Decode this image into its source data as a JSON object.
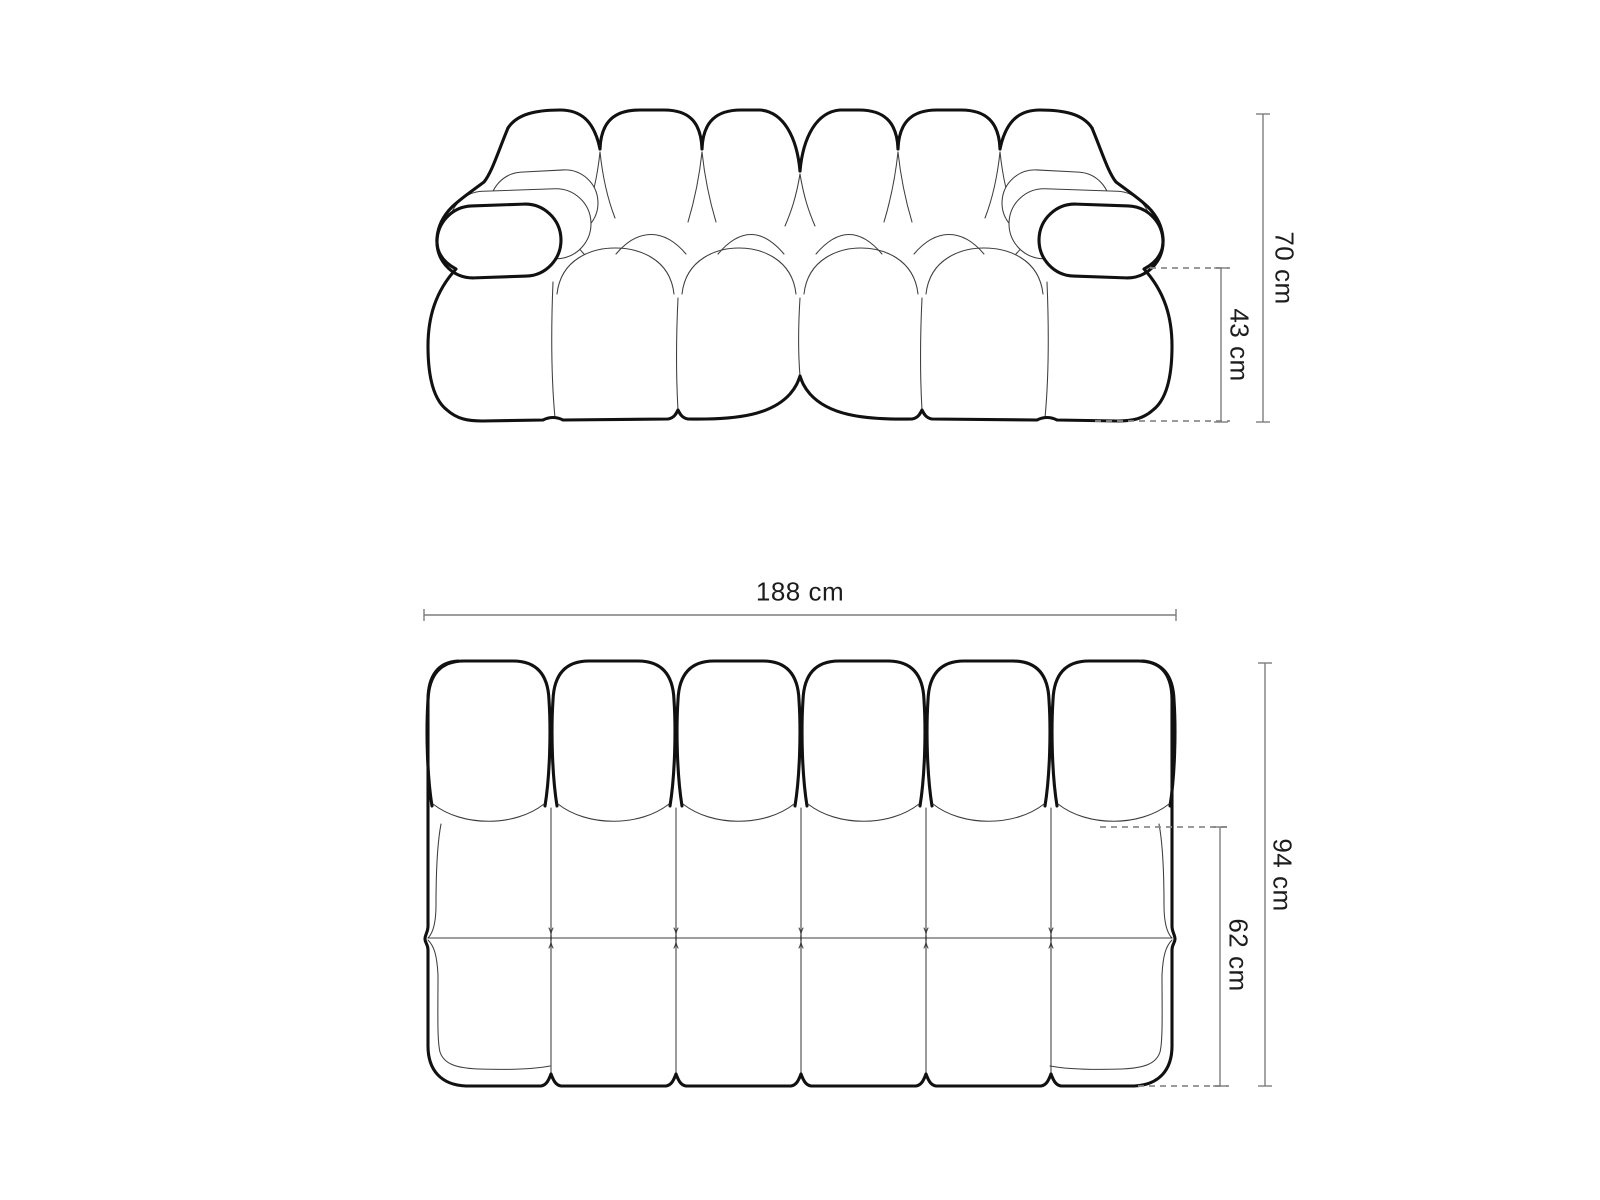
{
  "colors": {
    "background": "#ffffff",
    "outline": "#111111",
    "thin_line": "#3d3d3d",
    "dimension_line": "#7d7d7d",
    "dashed_line": "#8c8c8c",
    "text": "#1d1d1d"
  },
  "front_view": {
    "dim_total_height": "70 cm",
    "dim_seat_height": "43 cm"
  },
  "top_view": {
    "dim_width": "188 cm",
    "dim_total_depth": "94 cm",
    "dim_seat_depth": "62 cm"
  }
}
